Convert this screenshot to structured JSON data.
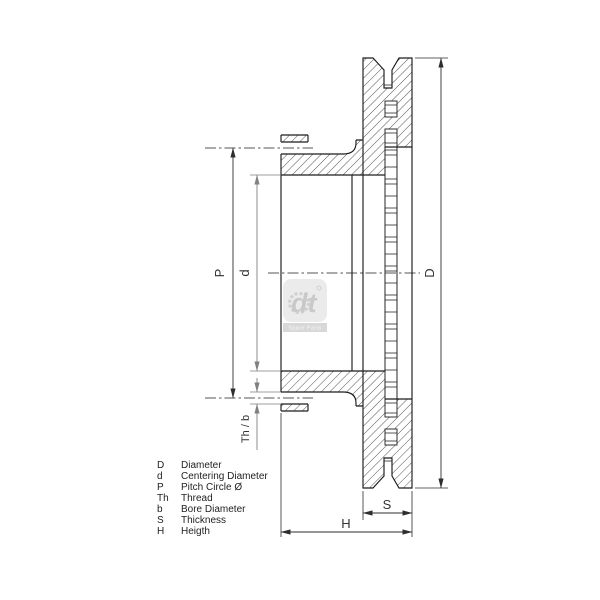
{
  "figure": {
    "title": "brake-disc-cross-section",
    "dim_labels": {
      "D": "D",
      "P": "P",
      "d": "d",
      "thb": "Th / b",
      "S": "S",
      "H": "H"
    },
    "legend": [
      {
        "key": "D",
        "desc": "Diameter"
      },
      {
        "key": "d",
        "desc": "Centering Diameter"
      },
      {
        "key": "P",
        "desc": "Pitch Circle Ø"
      },
      {
        "key": "Th",
        "desc": "Thread"
      },
      {
        "key": "b",
        "desc": "Bore Diameter"
      },
      {
        "key": "S",
        "desc": "Thickness"
      },
      {
        "key": "H",
        "desc": "Heigth"
      }
    ],
    "watermark": {
      "brand": "dt",
      "subtitle": "Spare Parts"
    },
    "colors": {
      "line": "#1c1c1c",
      "dim": "#2e2e2e",
      "dim_light": "#808080",
      "watermark_gray": "#c4c4c4",
      "background": "#ffffff"
    }
  }
}
